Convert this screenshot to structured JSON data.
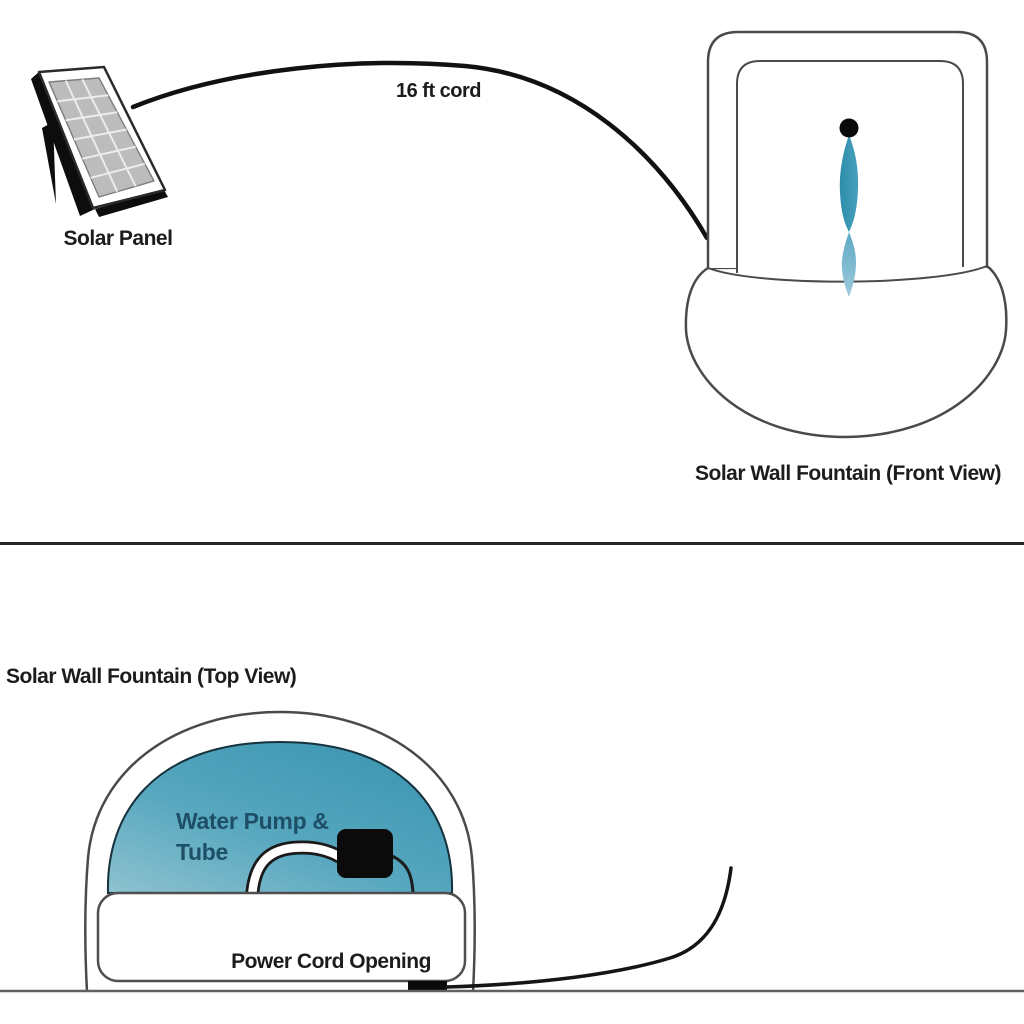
{
  "diagram_title": "Solar Wall Fountain setup diagram",
  "top_section": {
    "solar_panel_label": "Solar Panel",
    "cord_label": "16 ft cord",
    "front_view_label": "Solar Wall Fountain (Front View)"
  },
  "bottom_section": {
    "top_view_label": "Solar Wall Fountain (Top View)",
    "pump_label_line1": "Water Pump &",
    "pump_label_line2": "Tube",
    "opening_label": "Power Cord Opening"
  },
  "icons": {
    "solar_panel": "solar-panel-illustration",
    "cord": "power-cord-arc",
    "fountain_front": "wall-fountain-front-view",
    "water_spout": "water-spout-dot",
    "water_stream": "water-stream",
    "fountain_top": "wall-fountain-top-view",
    "water_basin": "water-basin-dome",
    "pump": "water-pump-block",
    "tube": "water-tube",
    "cord_opening": "power-cord-opening-block",
    "loose_cord": "loose-power-cord"
  },
  "colors": {
    "outline_gray": "#4a4a4a",
    "dark_line": "#161616",
    "panel_cell_gray": "#bcbcbc",
    "stream_teal_dark": "#2c8eac",
    "stream_teal_mid": "#4aa0bb",
    "stream_teal_light": "#5fa9c4",
    "stream_teal_pale": "#9ccadb",
    "dome_teal_deep": "#3b95b0",
    "dome_teal_mid": "#57a7bf",
    "dome_teal_light": "#8ec2d0",
    "pump_label_text": "#1d4f66",
    "caption_text": "#1c1c1c",
    "divider": "#262626",
    "ground": "#606060"
  }
}
